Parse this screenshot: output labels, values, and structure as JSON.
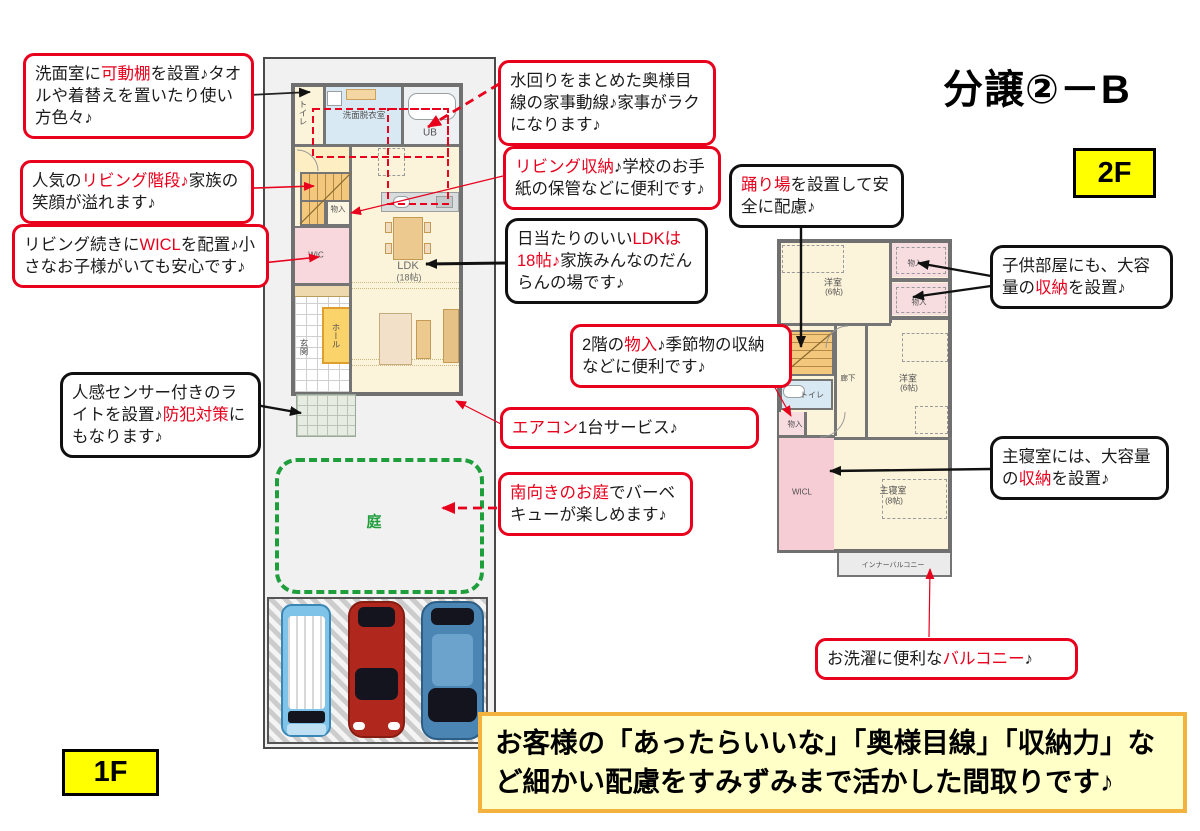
{
  "title": "分譲②－B",
  "floor_tags": {
    "f1": "1F",
    "f2": "2F"
  },
  "banner": "お客様の「あったらいいな」「奥様目線」「収納力」など細かい配慮をすみずみまで活かした間取りです♪",
  "colors": {
    "accent_red": "#e8001c",
    "tag_yellow": "#ffff00",
    "banner_bg": "#ffffc8",
    "banner_border": "#f3b13d",
    "garden_green": "#1f9e3c"
  },
  "callouts": [
    {
      "style": "red",
      "parts": [
        {
          "t": "洗面室に",
          "c": "k"
        },
        {
          "t": "可動棚",
          "c": "r"
        },
        {
          "t": "を設置♪タオルや着替えを置いたり使い方色々♪",
          "c": "k"
        }
      ]
    },
    {
      "style": "red",
      "parts": [
        {
          "t": "人気の",
          "c": "k"
        },
        {
          "t": "リビング階段♪",
          "c": "r"
        },
        {
          "t": "家族の笑顔が溢れます♪",
          "c": "k"
        }
      ]
    },
    {
      "style": "red",
      "parts": [
        {
          "t": "リビング続きに",
          "c": "k"
        },
        {
          "t": "WICL",
          "c": "r"
        },
        {
          "t": "を配置♪小さなお子様がいても安心です♪",
          "c": "k"
        }
      ]
    },
    {
      "style": "black",
      "parts": [
        {
          "t": "人感センサー付きのライトを設置♪",
          "c": "k"
        },
        {
          "t": "防犯対策",
          "c": "r"
        },
        {
          "t": "にもなります♪",
          "c": "k"
        }
      ]
    },
    {
      "style": "red",
      "parts": [
        {
          "t": "水回りをまとめた奥様目線の家事動線♪家事がラクになります♪",
          "c": "k"
        }
      ]
    },
    {
      "style": "red",
      "parts": [
        {
          "t": "リビング収納",
          "c": "r"
        },
        {
          "t": "♪学校のお手紙の保管などに便利です♪",
          "c": "k"
        }
      ]
    },
    {
      "style": "black",
      "parts": [
        {
          "t": "日当たりのいい",
          "c": "k"
        },
        {
          "t": "LDKは18帖♪",
          "c": "r"
        },
        {
          "t": "家族みんなのだんらんの場です♪",
          "c": "k"
        }
      ]
    },
    {
      "style": "red",
      "parts": [
        {
          "t": "2階の",
          "c": "k"
        },
        {
          "t": "物入",
          "c": "r"
        },
        {
          "t": "♪季節物の収納などに便利です♪",
          "c": "k"
        }
      ]
    },
    {
      "style": "red",
      "parts": [
        {
          "t": "エアコン",
          "c": "r"
        },
        {
          "t": "1台サービス♪",
          "c": "k"
        }
      ]
    },
    {
      "style": "red",
      "parts": [
        {
          "t": "南向きのお庭",
          "c": "r"
        },
        {
          "t": "でバーベキューが楽しめます♪",
          "c": "k"
        }
      ]
    },
    {
      "style": "black",
      "parts": [
        {
          "t": "踊り場",
          "c": "r"
        },
        {
          "t": "を設置して安全に配慮♪",
          "c": "k"
        }
      ]
    },
    {
      "style": "black",
      "parts": [
        {
          "t": "子供部屋にも、大容量の",
          "c": "k"
        },
        {
          "t": "収納",
          "c": "r"
        },
        {
          "t": "を設置♪",
          "c": "k"
        }
      ]
    },
    {
      "style": "black",
      "parts": [
        {
          "t": "主寝室には、大容量の",
          "c": "k"
        },
        {
          "t": "収納",
          "c": "r"
        },
        {
          "t": "を設置♪",
          "c": "k"
        }
      ]
    },
    {
      "style": "red",
      "parts": [
        {
          "t": "お洗濯に便利な",
          "c": "k"
        },
        {
          "t": "バルコニー",
          "c": "r"
        },
        {
          "t": "♪",
          "c": "k"
        }
      ]
    }
  ],
  "plan1f": {
    "labels": {
      "toilet": "トイレ",
      "washroom": "洗面脱衣室",
      "ub": "UB",
      "storage": "物入",
      "wic": "WIC",
      "ldk": "LDK",
      "ldk_size": "(18帖)",
      "hall": "ホール",
      "entrance": "玄関",
      "garden": "庭"
    }
  },
  "plan2f": {
    "labels": {
      "room1": "洋室",
      "room1_size": "(6帖)",
      "closet1": "物入",
      "closet2": "物入",
      "toilet": "トイレ",
      "corridor": "廊下",
      "room2": "洋室",
      "room2_size": "(6帖)",
      "storage": "物入",
      "wicl": "WICL",
      "master": "主寝室",
      "master_size": "(8帖)",
      "balcony": "インナーバルコニー"
    }
  }
}
